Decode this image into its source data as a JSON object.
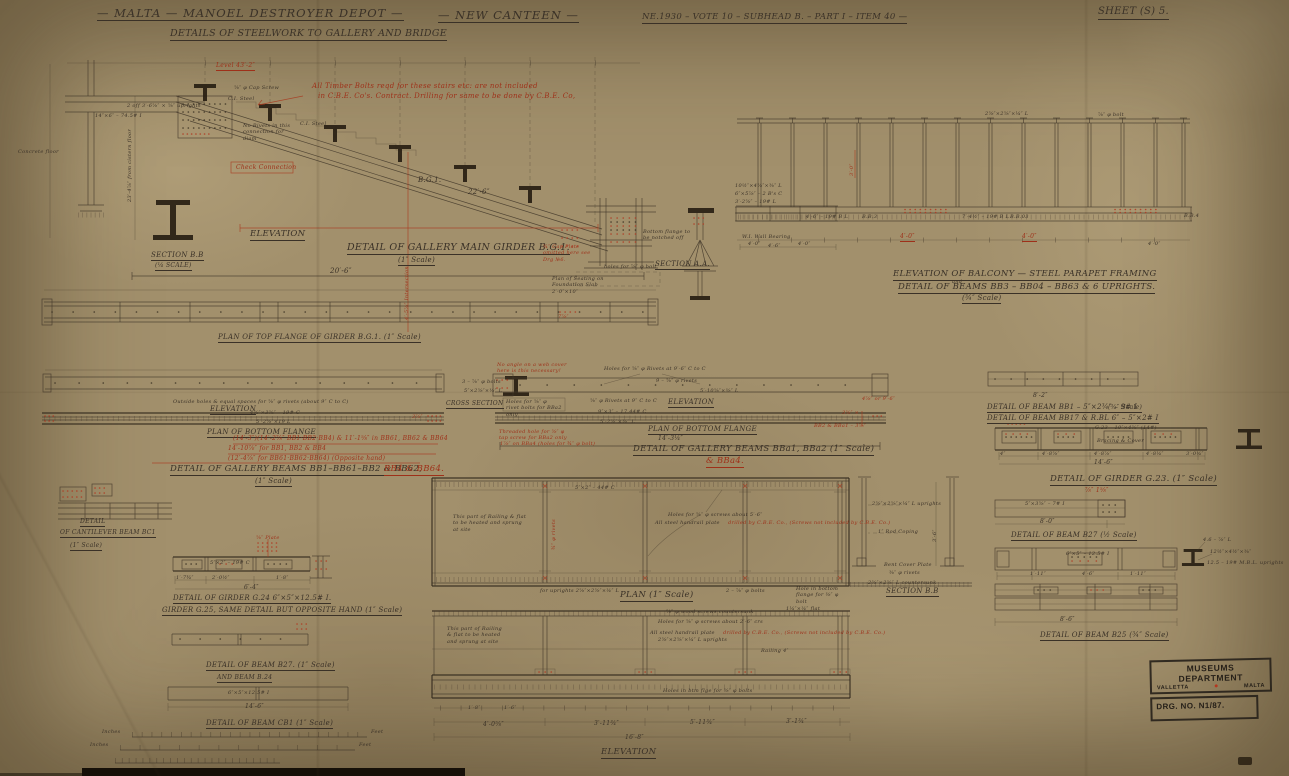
{
  "page": {
    "title": "— MALTA — MANOEL DESTROYER DEPOT —",
    "canteen": "— NEW CANTEEN —",
    "ref": "NE.1930 – VOTE 10 – SUBHEAD B. – PART I – ITEM 40 —",
    "sheet": "SHEET (S) 5.",
    "subtitle": "DETAILS OF STEELWORK TO GALLERY AND BRIDGE"
  },
  "notes": {
    "timber1": "All Timber Bolts reqd for these stairs etc: are not included",
    "timber2": "in C.B.E. Co's. Contract. Drilling for same to be done by C.B.E. Co,"
  },
  "gal": {
    "level": "Level 43′-2″",
    "capscrew": "⅝″ φ Cap Screw",
    "cisteel1": "C.I. Steel",
    "cisteel2": "C.I. Steel",
    "uprights": "2 off 3′-6⅝″ × ⅝″ uprights",
    "beam14": "14″×6″ – 74.5# I",
    "norivets": "No Rivets in this connection for diam",
    "check": "Check Connection",
    "inter": "4′-5⅞″ Intersection",
    "bg1": "B.G.1.",
    "d226": "22′-6″",
    "elev": "ELEVATION",
    "secbb": "SECTION B.B",
    "secbbsc": "(¼ SCALE)",
    "title": "DETAIL OF GALLERY MAIN GIRDER B.G.1.",
    "scale": "(1″ Scale)",
    "d206": "20′-6″",
    "capplate": "¾″ Cap Plate omitted here see Drg №6.",
    "holes78": "holes for ⅞″ φ bolt",
    "seating": "Plan of Seating on Foundation Slab 2′-0″×10″",
    "cistern": "23′-4⅞″ from cistern floor",
    "cfloor": "Concrete floor"
  },
  "saa": {
    "label": "SECTION A.A.",
    "notch": "Bottom flange to be notched off",
    "wb": "W.I. Wall Bearing",
    "d46": "4′-6″",
    "a1": "10½″×4⅝″×⅜″ L",
    "a2": "6″×5⅞″ – 2 B's C",
    "a3": "3′-2⅝″ – 19# L"
  },
  "bal": {
    "t1": "ELEVATION OF BALCONY — STEEL PARAPET FRAMING",
    "and": "and",
    "t2": "DETAIL OF BEAMS BB3 – BB04 – BB63 & 6 UPRIGHTS.",
    "sc": "(¾″ Scale)",
    "d40a": "4′-0″",
    "d40b": "4′-0″",
    "upr": "2⅝″×2⅝″×¼″ L",
    "bolt": "⅞″ φ bolt",
    "postdim": "3′-0″",
    "bb3": "B.B.3",
    "bb03": "B.B.03",
    "bb4": "B.B.4",
    "m1": "4′-6″ – 19# B L",
    "m2": "7′-4½″ – 19# B L",
    "d1": "4′-0″",
    "d2": "4′-0″",
    "d3": "4′-0″"
  },
  "tf": {
    "title": "PLAN OF TOP FLANGE OF GIRDER B.G.1. (1″ Scale)",
    "red78": "7⅞″"
  },
  "bl": {
    "holes": "Outside holes & equal spaces for ⅝″ φ rivets (about 9″ C to C)",
    "elev": "ELEVATION",
    "ch1": "4⅝″×3⅝″ – 19# C",
    "ch2": "5′-2⅝″×19 L",
    "pbf": "PLAN OF BOTTOM FLANGE",
    "r1": "(14′-3″)(14′-2⅞″ BB1·BB2·BB4) & 11′-1⅝″ in BB61, BB62 & BB64",
    "r2": "14′-10⅞″ for BB1, BB2 & BB4",
    "r3": "(12′-4⅞″ for BB61·BB62·BB64) (Opposite hand)",
    "title": "DETAIL OF GALLERY BEAMS BB1–BB61–BB2 & BB62,",
    "tred": "BB4 & BB64.",
    "sc": "(1″ Scale)",
    "r38": "3⅞″",
    "cs": "CROSS SECTION",
    "b3": "3 – ⅞″ φ bolts",
    "ang": "5″×2⅝″×⅜″ L"
  },
  "bc": {
    "web": "No angle on a web cover here is this necessary!",
    "h1": "Holes for ⅝″ φ Rivets at 9′-6″ C to C",
    "r9": "9 – ⅝″ φ rivets",
    "d510": "5′-10⅝″×⅜″ L",
    "box": "Holes for ⅝″ φ rivet bolts for BBa2 only",
    "r58": "⅝″ φ Rivets at 9″ C to C",
    "elev": "ELEVATION",
    "ch1": "9″×3″ – 17.44# C",
    "ch2": "5′-2⅝″×⅜″ L",
    "thr": "Threaded hole for ⅝″ φ tap screw for BBa2 only",
    "bba4": "1⅞″ on BBa4 (holes for ¾″ φ bolt)",
    "pbf": "PLAN OF BOTTOM FLANGE",
    "d": "14′-3¼″",
    "title": "DETAIL OF GALLERY BEAMS BBa1, BBa2 (1″ Scale)",
    "tred": "& BBa4.",
    "rbb2": "BB2 & BBa1 – 3⅞″",
    "r35": "3⅝″ ×",
    "r96": "4⅞″ or 9′-6″"
  },
  "rc": {
    "d82": "8′-2″",
    "bb1": "DETAIL OF BEAM BB1 – 5″×2¾″ – 9# I",
    "bb1sc": "(¾″ Scale)",
    "bb17": "DETAIL OF BEAM BB17 & R.BL 6″ – 5″×2# I",
    "cell": "G.23 – 10″×4⅝″ (14#)",
    "brace": "Bracing & Cover",
    "d1": "4″",
    "d2": "4′-8⅝″",
    "d3": "4′-8⅞″",
    "d4": "4′-8¼″",
    "d5": "3′-0¼″",
    "total": "14′-6″",
    "g23": "DETAIL OF GIRDER G.23. (1″ Scale)",
    "red": "⅞″ 1⅝″",
    "b27cell": "5″×3⅝″ – 7# I",
    "b27d": "8′-0″",
    "b27": "DETAIL OF BEAM B27 (½ Scale)",
    "b2cell": "6″×5″ – 12.5# I",
    "bd1": "1′-11″",
    "bd2": "4′-6″",
    "bd3": "1′-11″",
    "d86": "8′-6″",
    "b25": "DETAIL OF BEAM B25 (¾″ Scale)",
    "n1": "4.6 – ⅞″ L",
    "n2": "12½″×4½″×⅜″",
    "n3": "12.5 – 19# M.B.L. uprights"
  },
  "pa": {
    "label": "PLAN (1″ Scale)",
    "upr": "for uprights 2⅝″×2⅝″×¼″ L",
    "b2": "2 – ⅞″ φ bolts",
    "hbf": "Hole in bottom flange for ⅜″ φ bolt",
    "note": "This part of Railing & flat to be heated and sprung at site",
    "n2": "Holes for ⅝″ φ screws about 5′-6″",
    "hrb": "All steel handrail plate",
    "hrr": "drilled by C.B.E. Co., (Screws not included by C.B.E. Co.)",
    "rv": "¾″ φ rivets",
    "top": "5″×2″ – 44# C",
    "secbb": "SECTION B.B",
    "s1": "2⅝″×2⅝″×¼″ L uprights",
    "s2": "1″ Rod Coping",
    "s3": "Bent Cover Plate",
    "s4": "⅜″ φ rivets",
    "s5": "2⅝″×2⅝″ L countersunk",
    "sd": "3′-6″"
  },
  "ea": {
    "note": "This part of Railing & flat to be heated and sprung at site",
    "n0": "Holes for ⅝″ φ screws about 2′-6″ crs",
    "n1": "⅝″ φ wood screws countersunk",
    "n2": "1¼″×¼″ flat",
    "hrb": "All steel handrail plate",
    "hrr": "drilled by C.B.E. Co., (Screws not included by C.B.E. Co.)",
    "upr": "2⅝″×2⅝″×¼″ L uprights",
    "rail": "Railing 4″",
    "hbf": "Holes in btm flge for ⅜″ φ bolts",
    "t1": "1′-8″",
    "t2": "1′-6″",
    "d1": "4′-0⅝″",
    "d2": "3′-11¾″",
    "d3": "5′-11¾″",
    "d4": "3′-1¾″",
    "total": "16′-8″",
    "label": "ELEVATION"
  },
  "lc": {
    "det": "DETAIL",
    "cant": "OF CANTILEVER BEAM BC1",
    "sc": "(1″ Scale)",
    "plate": "⅝″ Plate",
    "g24cell": "5″×2″ – 19# C",
    "gd1": "1′-7¾″",
    "gd2": "2′-0½″",
    "gd3": "1′-8″",
    "gt": "6′-4″",
    "g24": "DETAIL OF GIRDER G.24  6″×5″×12.5# I.",
    "g25": "GIRDER G.25, SAME DETAIL BUT OPPOSITE HAND (1″ Scale)",
    "b27": "DETAIL OF BEAM B27. (1″ Scale)",
    "b24": "AND BEAM B.24",
    "cb1cell": "6″×5″×12.5# I",
    "cb1d": "14′-6″",
    "cb1": "DETAIL OF BEAM CB1 (1″ Scale)",
    "in1": "Inches",
    "ft1": "Feet",
    "in2": "Inches",
    "ft2": "Feet"
  },
  "stamp": {
    "l1": "MUSEUMS DEPARTMENT",
    "city": "VALLETTA",
    "emblem": "●",
    "country": "MALTA",
    "drg": "DRG. NO. N1/87."
  }
}
